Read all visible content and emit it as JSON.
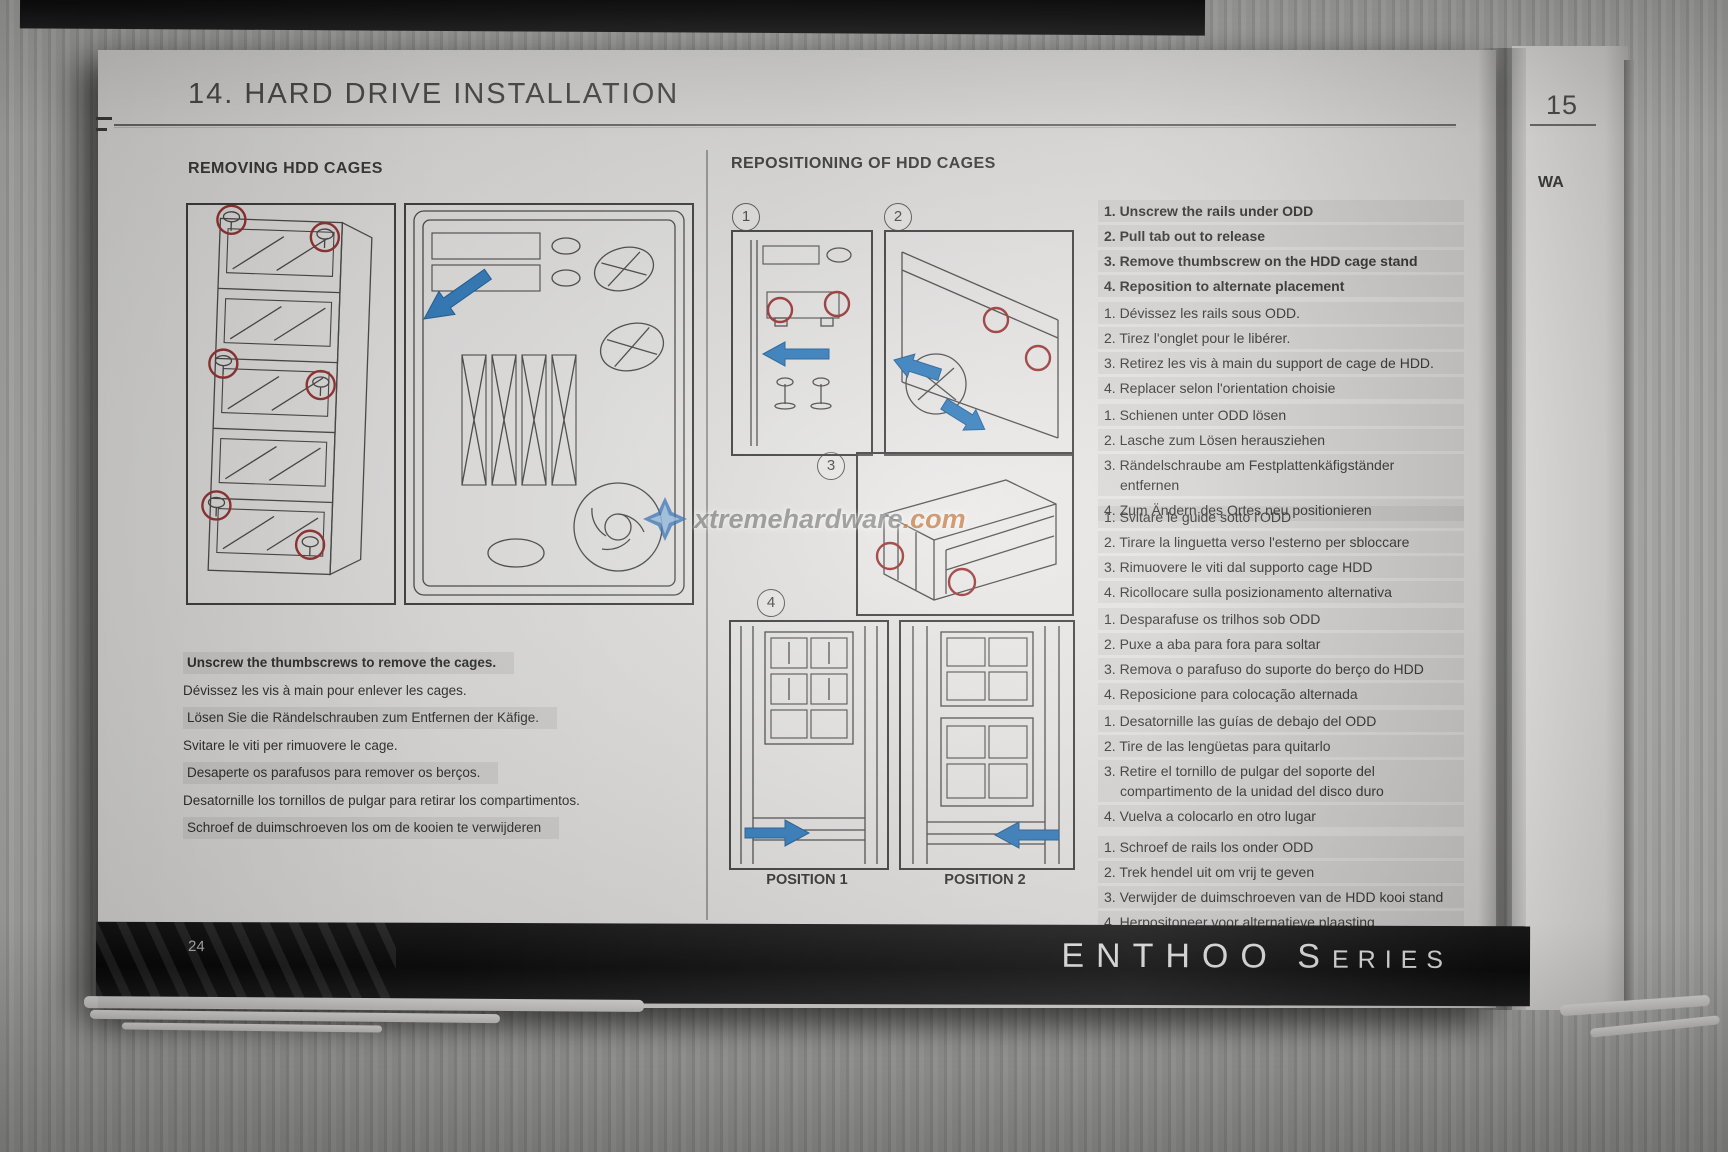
{
  "photo": {
    "watermark": {
      "site": "xtremehardware",
      "tld": ".com"
    }
  },
  "page": {
    "title": "14. HARD DRIVE INSTALLATION",
    "page_number": "24",
    "brand_primary": "ENTHOO",
    "brand_secondary_initial": "S",
    "brand_secondary_rest": "ERIES"
  },
  "adjacent_page": {
    "section_number": "15",
    "heading_fragment": "WA"
  },
  "removing": {
    "heading": "REMOVING HDD CAGES",
    "captions": [
      "Unscrew the thumbscrews to remove the cages.",
      "Dévissez les vis à main pour enlever les cages.",
      "Lösen Sie die Rändelschrauben zum Entfernen der Käfige.",
      "Svitare le viti per rimuovere le cage.",
      "Desaperte os parafusos para remover os berços.",
      "Desatornille los tornillos de pulgar para retirar los compartimentos.",
      "Schroef de duimschroeven los om de kooien te verwijderen"
    ]
  },
  "repositioning": {
    "heading": "REPOSITIONING OF HDD CAGES",
    "step_numbers": [
      "1",
      "2",
      "3",
      "4"
    ],
    "position_labels": [
      "POSITION 1",
      "POSITION 2"
    ],
    "instructions": [
      {
        "lang": "en",
        "items": [
          "1. Unscrew the rails under ODD",
          "2. Pull tab out to release",
          "3. Remove thumbscrew on the HDD cage stand",
          "4. Reposition to alternate placement"
        ]
      },
      {
        "lang": "fr",
        "items": [
          "1. Dévissez les rails sous ODD.",
          "2. Tirez l'onglet pour le libérer.",
          "3. Retirez les vis à main du support de cage de HDD.",
          "4. Replacer selon l'orientation choisie"
        ]
      },
      {
        "lang": "de",
        "items": [
          "1. Schienen unter ODD lösen",
          "2. Lasche zum Lösen herausziehen",
          "3. Rändelschraube am Festplattenkäfigständer entfernen",
          "4. Zum Ändern des Ortes neu positionieren"
        ]
      },
      {
        "lang": "it",
        "items": [
          "1. Svitare le guide sotto l'ODD",
          "2. Tirare la linguetta verso l'esterno per sbloccare",
          "3. Rimuovere le viti dal supporto cage HDD",
          "4. Ricollocare sulla posizionamento alternativa"
        ]
      },
      {
        "lang": "pt",
        "items": [
          "1. Desparafuse os trilhos sob ODD",
          "2. Puxe a aba para fora para soltar",
          "3. Remova o parafuso do suporte do berço do HDD",
          "4. Reposicione para colocação alternada"
        ]
      },
      {
        "lang": "es",
        "items": [
          "1. Desatornille las guías de debajo del ODD",
          "2. Tire de las lengüetas para quitarlo",
          "3. Retire el tornillo de pulgar del soporte del compartimento de la unidad del disco duro",
          "4. Vuelva a colocarlo en otro lugar"
        ]
      },
      {
        "lang": "nl",
        "items": [
          "1. Schroef de rails los onder ODD",
          "2. Trek hendel uit om vrij te geven",
          "3. Verwijder de duimschroeven van de HDD kooi stand",
          "4. Herpositoneer voor alternatieve plaasting"
        ]
      }
    ]
  }
}
